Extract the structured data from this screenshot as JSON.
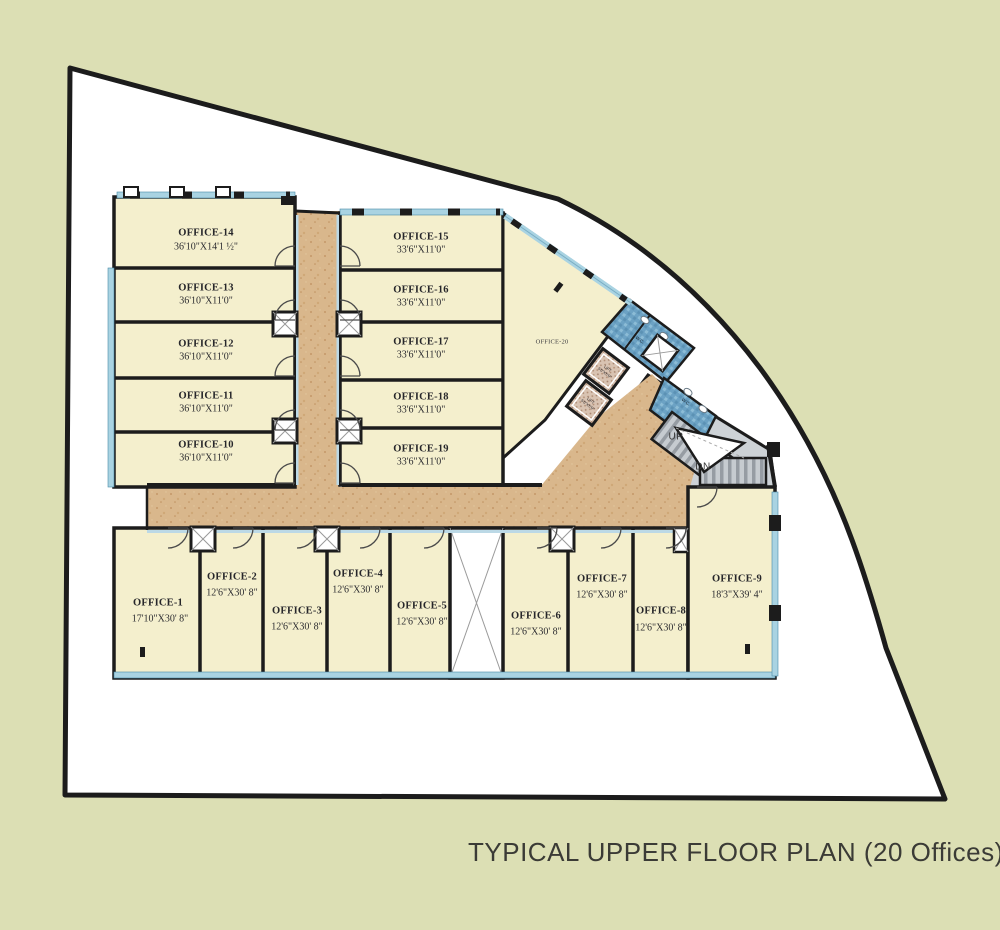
{
  "title": "TYPICAL UPPER FLOOR PLAN (20 Offices)",
  "offices": {
    "o1": {
      "label": "OFFICE-1",
      "dims": "17'10\"X30' 8\""
    },
    "o2": {
      "label": "OFFICE-2",
      "dims": "12'6\"X30' 8\""
    },
    "o3": {
      "label": "OFFICE-3",
      "dims": "12'6\"X30' 8\""
    },
    "o4": {
      "label": "OFFICE-4",
      "dims": "12'6\"X30' 8\""
    },
    "o5": {
      "label": "OFFICE-5",
      "dims": "12'6\"X30' 8\""
    },
    "o6": {
      "label": "OFFICE-6",
      "dims": "12'6\"X30' 8\""
    },
    "o7": {
      "label": "OFFICE-7",
      "dims": "12'6\"X30' 8\""
    },
    "o8": {
      "label": "OFFICE-8",
      "dims": "12'6\"X30' 8\""
    },
    "o9": {
      "label": "OFFICE-9",
      "dims": "18'3\"X39' 4\""
    },
    "o10": {
      "label": "OFFICE-10",
      "dims": "36'10\"X11'0\""
    },
    "o11": {
      "label": "OFFICE-11",
      "dims": "36'10\"X11'0\""
    },
    "o12": {
      "label": "OFFICE-12",
      "dims": "36'10\"X11'0\""
    },
    "o13": {
      "label": "OFFICE-13",
      "dims": "36'10\"X11'0\""
    },
    "o14": {
      "label": "OFFICE-14",
      "dims": "36'10\"X14'1 ½\""
    },
    "o15": {
      "label": "OFFICE-15",
      "dims": "33'6\"X11'0\""
    },
    "o16": {
      "label": "OFFICE-16",
      "dims": "33'6\"X11'0\""
    },
    "o17": {
      "label": "OFFICE-17",
      "dims": "33'6\"X11'0\""
    },
    "o18": {
      "label": "OFFICE-18",
      "dims": "33'6\"X11'0\""
    },
    "o19": {
      "label": "OFFICE-19",
      "dims": "33'6\"X11'0\""
    },
    "o20": {
      "label": "OFFICE-20"
    }
  },
  "stairs": {
    "up": "UP",
    "dn": "DN"
  },
  "lift": {
    "label": "LIFT",
    "dims": "5'0\"X5'0\""
  },
  "toilet": {
    "wc": "W.C."
  },
  "colors": {
    "background": "#dcdfb4",
    "site": "#ffffff",
    "boundary": "#1c1c1c",
    "office_fill": "#f4efcd",
    "wall": "#1c1c1c",
    "corridor": "#d9b78c",
    "window_blue": "#a9d3e2",
    "toilet_tile": "#6ca2c4",
    "stair_gray": "#c6cbd0"
  }
}
